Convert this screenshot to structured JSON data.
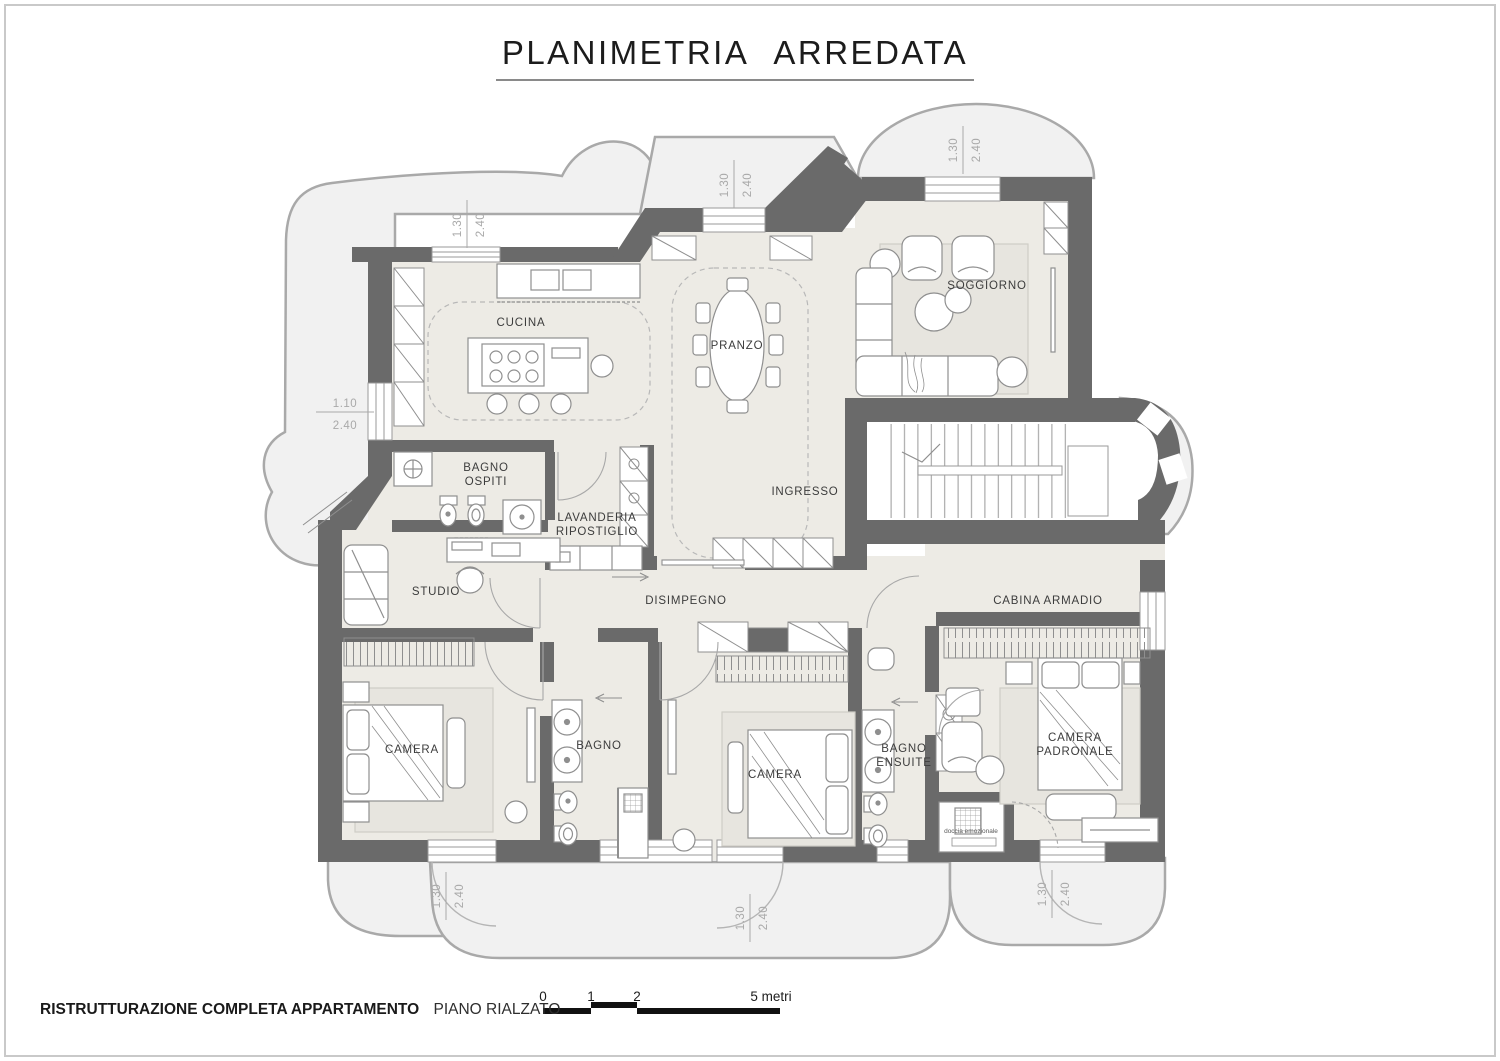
{
  "title": "PLANIMETRIA ARREDATA",
  "footer": {
    "project": "RISTRUTTURAZIONE COMPLETA APPARTAMENTO",
    "floor": "PIANO RIALZATO"
  },
  "scale_bar": {
    "tick0": "0",
    "tick1": "1",
    "tick2": "2",
    "tick5": "5 metri"
  },
  "rooms": {
    "cucina": "CUCINA",
    "pranzo": "PRANZO",
    "soggiorno": "SOGGIORNO",
    "bagno_ospiti_1": "BAGNO",
    "bagno_ospiti_2": "OSPITI",
    "lavanderia_1": "LAVANDERIA",
    "lavanderia_2": "RIPOSTIGLIO",
    "ingresso": "INGRESSO",
    "studio": "STUDIO",
    "disimpegno": "DISIMPEGNO",
    "cabina_armadio": "CABINA  ARMADIO",
    "camera_sinistra": "CAMERA",
    "bagno": "BAGNO",
    "camera_centrale": "CAMERA",
    "bagno_ensuite_1": "BAGNO",
    "bagno_ensuite_2": "ENSUITE",
    "camera_padronale_1": "CAMERA",
    "camera_padronale_2": "PADRONALE",
    "doccia_emozionale": "doccia emozionale"
  },
  "dimensions": {
    "win_cucina": {
      "w": "1.30",
      "h": "2.40"
    },
    "win_pranzo": {
      "w": "1.30",
      "h": "2.40"
    },
    "win_soggiorno": {
      "w": "1.30",
      "h": "2.40"
    },
    "win_sinistra": {
      "w": "1.10",
      "h": "2.40"
    },
    "win_camera_sx": {
      "w": "1.30",
      "h": "2.40"
    },
    "win_camera_centro": {
      "w": "1.30",
      "h": "2.40"
    },
    "win_camera_padronale": {
      "w": "1.30",
      "h": "2.40"
    }
  },
  "colors": {
    "wall": "#6a6a6a",
    "floor": "#edebe5",
    "terrace": "#f1f1f1",
    "terrace_stroke": "#a9a9a9",
    "furniture_stroke": "#8f8f8f",
    "label_text": "#3c3c3c",
    "dim_text": "#a9a9a9"
  }
}
